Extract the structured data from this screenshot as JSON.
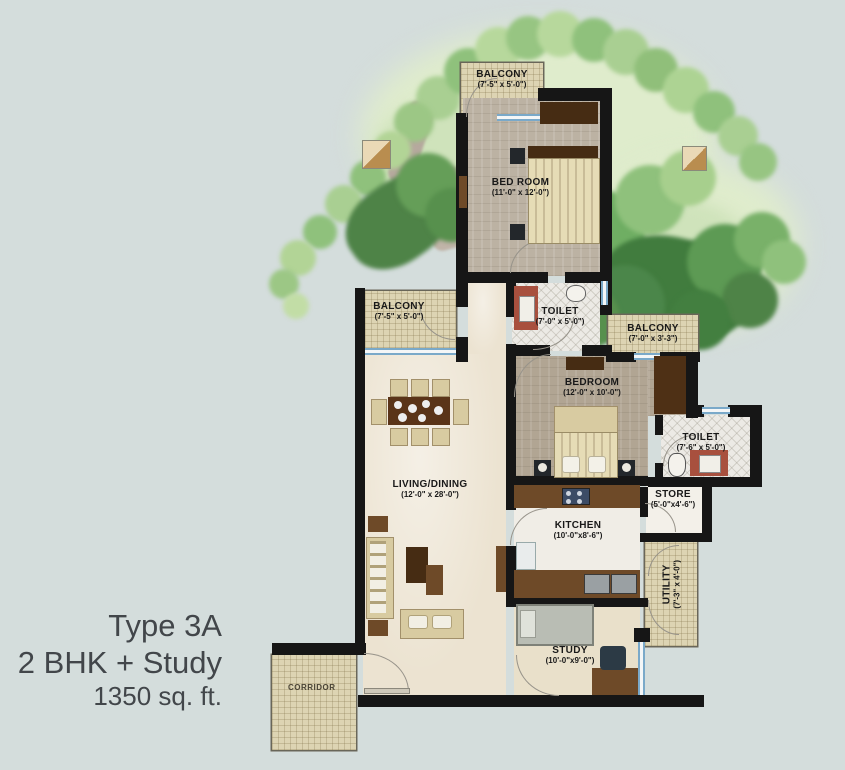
{
  "title": {
    "line1": "Type 3A",
    "line2": "2 BHK + Study",
    "line3": "1350 sq. ft."
  },
  "rooms": {
    "balcony_top": {
      "name": "BALCONY",
      "dims": "(7'-5\" x 5'-0\")"
    },
    "bedroom1": {
      "name": "BED ROOM",
      "dims": "(11'-0\" x 12'-0\")"
    },
    "toilet1": {
      "name": "TOILET",
      "dims": "(7'-0\" x 5'-0\")"
    },
    "balcony_right": {
      "name": "BALCONY",
      "dims": "(7'-0\" x 3'-3\")"
    },
    "balcony_left": {
      "name": "BALCONY",
      "dims": "(7'-5\" x 5'-0\")"
    },
    "bedroom2": {
      "name": "BEDROOM",
      "dims": "(12'-0\" x 10'-0\")"
    },
    "toilet2": {
      "name": "TOILET",
      "dims": "(7'-6\" x 5'-0\")"
    },
    "store": {
      "name": "STORE",
      "dims": "(5'-0\"x4'-6\")"
    },
    "living": {
      "name": "LIVING/DINING",
      "dims": "(12'-0\" x 28'-0\")"
    },
    "kitchen": {
      "name": "KITCHEN",
      "dims": "(10'-0\"x8'-6\")"
    },
    "utility": {
      "name": "UTILITY",
      "dims": "(7'-3\" x 4'-0\")"
    },
    "study": {
      "name": "STUDY",
      "dims": "(10'-0\"x9'-0\")"
    },
    "corridor": {
      "name": "CORRIDOR"
    }
  },
  "palette": {
    "background": "#d4dddc",
    "wall": "#161616",
    "balcony_fill": "#ddd4b3",
    "window_blue": "#7aa9c9",
    "wood": "#6e4a28",
    "tree_dark": "#467e40",
    "tree_light": "#b7d89c",
    "title_text": "#42464a"
  }
}
